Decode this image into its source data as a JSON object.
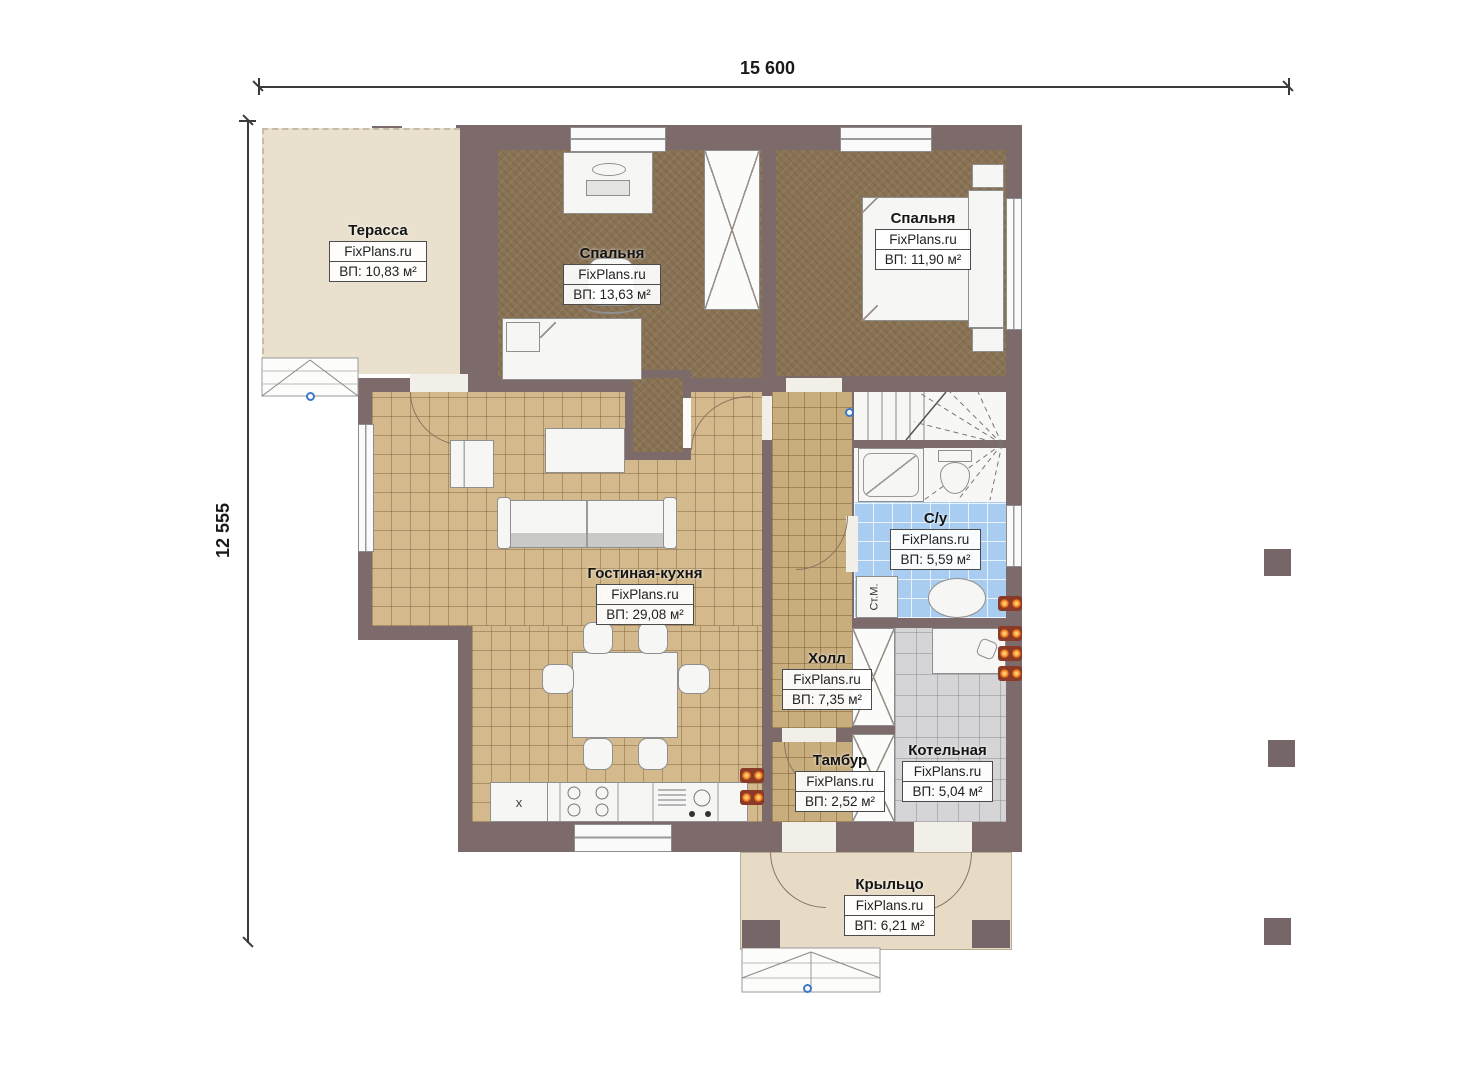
{
  "dimensions": {
    "top": "15 600",
    "left": "12 555"
  },
  "watermark": "FixPlans.ru",
  "rooms": {
    "terrace": {
      "name": "Терасса",
      "area": "ВП: 10,83 м²"
    },
    "bedroom1": {
      "name": "Спальня",
      "area": "ВП: 13,63 м²"
    },
    "bedroom2": {
      "name": "Спальня",
      "area": "ВП: 11,90 м²"
    },
    "living": {
      "name": "Гостиная-кухня",
      "area": "ВП: 29,08 м²"
    },
    "bathroom": {
      "name": "С/у",
      "area": "ВП: 5,59 м²"
    },
    "hall": {
      "name": "Холл",
      "area": "ВП: 7,35 м²"
    },
    "vestibule": {
      "name": "Тамбур",
      "area": "ВП: 2,52 м²"
    },
    "boiler": {
      "name": "Котельная",
      "area": "ВП: 5,04 м²"
    },
    "porch": {
      "name": "Крыльцо",
      "area": "ВП: 6,21 м²"
    }
  },
  "labels": {
    "washing_machine": "Ст.М.",
    "fridge_mark": "x"
  },
  "colors": {
    "wall": "#7d6b6c",
    "bedroom_floor": "#8a7355",
    "tile_floor": "#d3b98b",
    "hall_floor": "#c8ad7d",
    "bathroom_floor": "#a9cdf0",
    "boiler_floor": "#d5d5d7",
    "terrace_floor": "#e9e0ce",
    "porch_floor": "#e7dbc6",
    "radiator": "#f07818"
  }
}
